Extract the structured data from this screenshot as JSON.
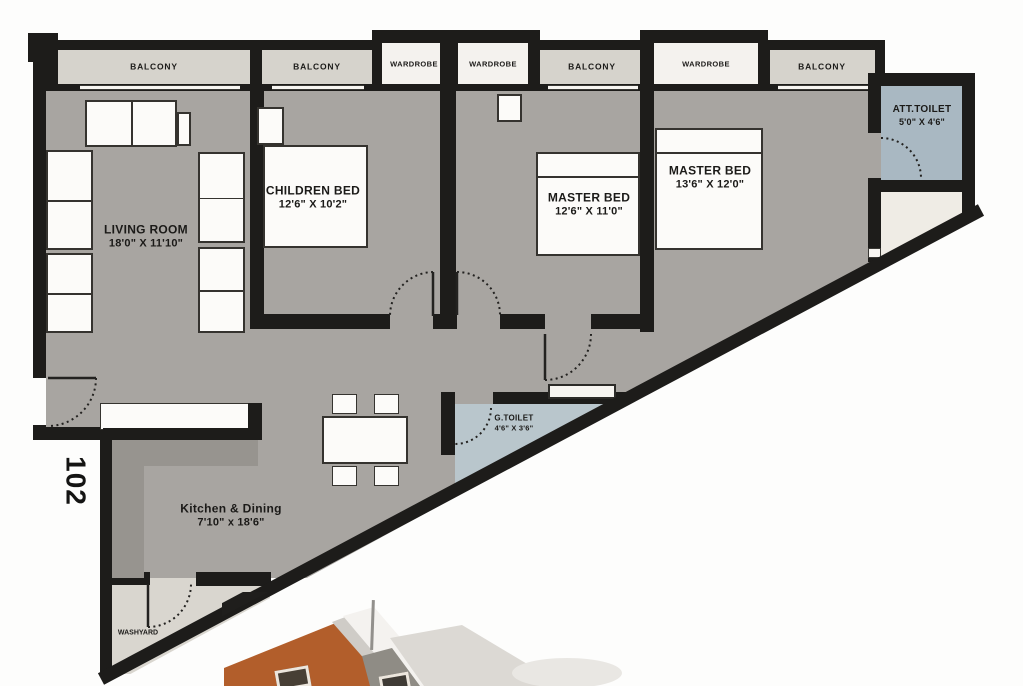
{
  "unit": {
    "number": "102"
  },
  "top_strip": {
    "balconies": [
      {
        "label": "BALCONY"
      },
      {
        "label": "BALCONY"
      },
      {
        "label": "BALCONY"
      },
      {
        "label": "BALCONY"
      }
    ],
    "wardrobes": [
      {
        "label": "WARDROBE"
      },
      {
        "label": "WARDROBE"
      },
      {
        "label": "WARDROBE"
      }
    ]
  },
  "rooms": {
    "living": {
      "name": "LIVING ROOM",
      "dims": "18'0\" X 11'10\""
    },
    "children": {
      "name": "CHILDREN BED",
      "dims": "12'6\" X 10'2\""
    },
    "master1": {
      "name": "MASTER BED",
      "dims": "12'6\" X 11'0\""
    },
    "master2": {
      "name": "MASTER BED",
      "dims": "13'6\" X 12'0\""
    },
    "att_toilet": {
      "name": "ATT.TOILET",
      "dims": "5'0\" X 4'6\""
    },
    "g_toilet": {
      "name": "G.TOILET",
      "dims": "4'6\" X 3'6\""
    },
    "kitchen": {
      "name": "Kitchen & Dining",
      "dims": "7'10\" x 18'6\""
    },
    "washyard": {
      "name": "WASHYARD"
    }
  },
  "colors": {
    "wall": "#1d1c1a",
    "floor_gray": "#a8a5a1",
    "balcony_gray": "#d6d3cc",
    "wardrobe_white": "#f4f2ee",
    "att_toilet_blue": "#a9b8c2",
    "g_toilet_blue": "#b9c6cc",
    "cream": "#efece5",
    "washyard_gray": "#d9d6cf",
    "counter_gray": "#97948f",
    "furniture_white": "#fcfbf9",
    "photo_orange": "#b25e2b"
  }
}
